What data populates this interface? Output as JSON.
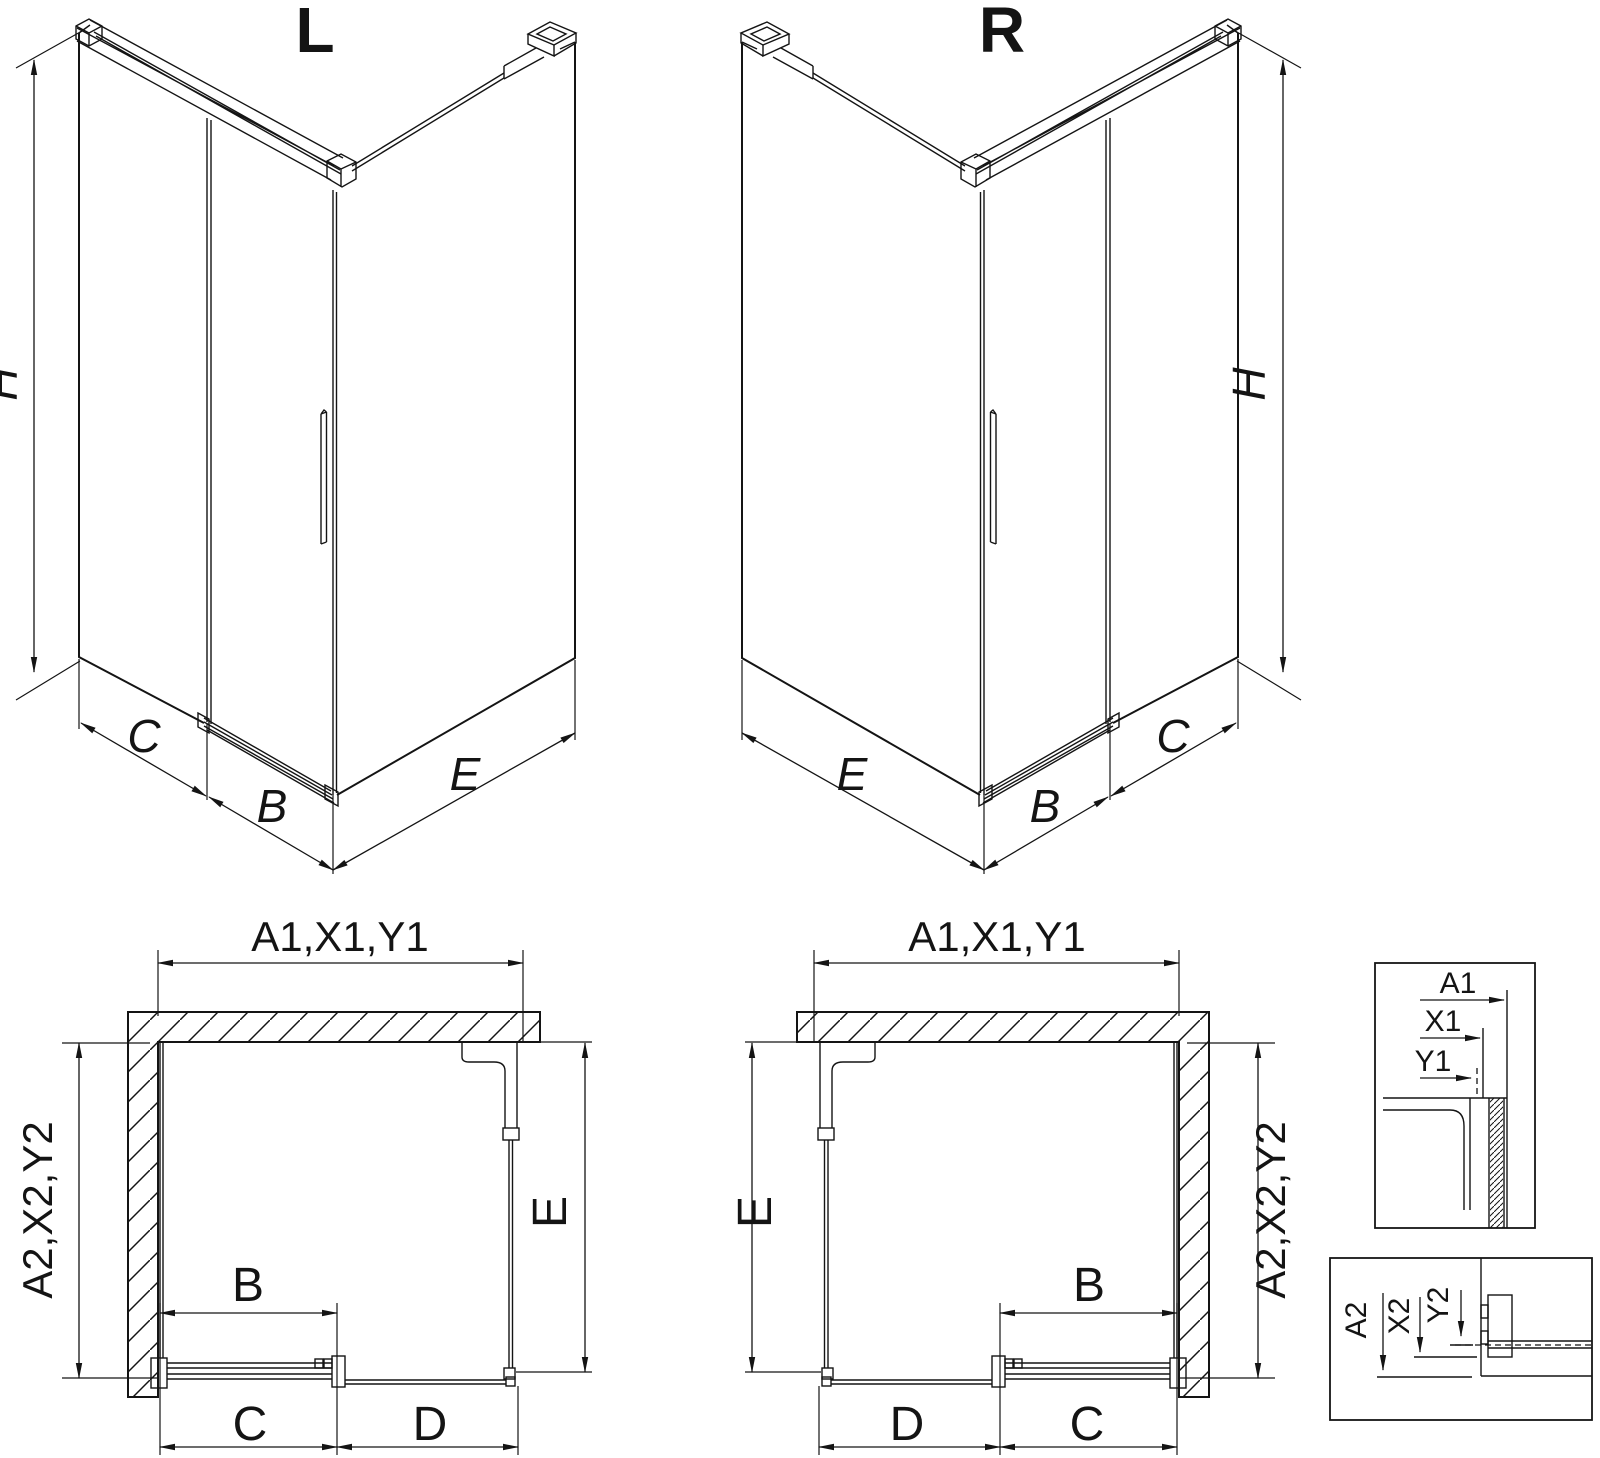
{
  "drawing": {
    "background_color": "#ffffff",
    "line_color": "#141414"
  },
  "iso_left": {
    "title": "L",
    "dim_height": "H",
    "dim_side_panel": "C",
    "dim_door": "B",
    "dim_front": "E"
  },
  "iso_right": {
    "title": "R",
    "dim_height": "H",
    "dim_side_panel": "C",
    "dim_door": "B",
    "dim_front": "E"
  },
  "plan_left": {
    "dim_top": "A1,X1,Y1",
    "dim_left": "A2,X2,Y2",
    "dim_right": "E",
    "dim_door": "B",
    "dim_bottom_left": "C",
    "dim_bottom_right": "D"
  },
  "plan_right": {
    "dim_top": "A1,X1,Y1",
    "dim_left": "E",
    "dim_right": "A2,X2,Y2",
    "dim_door": "B",
    "dim_bottom_left": "D",
    "dim_bottom_right": "C"
  },
  "detail_top": {
    "labels": [
      "A1",
      "X1",
      "Y1"
    ]
  },
  "detail_bottom": {
    "labels": [
      "A2",
      "X2",
      "Y2"
    ]
  }
}
